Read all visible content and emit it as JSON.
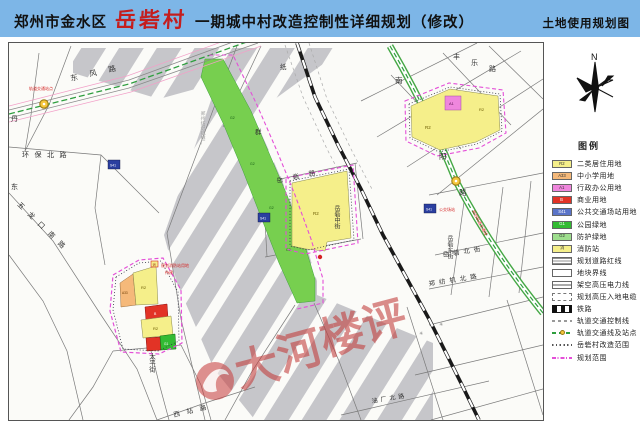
{
  "header": {
    "region": "郑州市金水区",
    "village": "岳砦村",
    "title_rest": "一期城中村改造控制性详细规划（修改）",
    "right_label": "土地使用规划图"
  },
  "side": {
    "compass_label": "N",
    "legend_title": "图例",
    "items": [
      {
        "code": "R2",
        "label": "二类居住用地",
        "type": "fill",
        "color": "#f5ef8a"
      },
      {
        "code": "A33",
        "label": "中小学用地",
        "type": "fill",
        "color": "#f5b97a"
      },
      {
        "code": "A1",
        "label": "行政办公用地",
        "type": "fill",
        "color": "#ef86dd"
      },
      {
        "code": "B",
        "label": "商业用地",
        "type": "fill",
        "color": "#e23326"
      },
      {
        "code": "S41",
        "label": "公共交通场站用地",
        "type": "fill",
        "color": "#5a74c8"
      },
      {
        "code": "G1",
        "label": "公园绿地",
        "type": "fill",
        "color": "#33bb33"
      },
      {
        "code": "G2",
        "label": "防护绿地",
        "type": "fill",
        "color": "#9ede8e"
      },
      {
        "code": "消",
        "label": "消防站",
        "type": "fill",
        "color": "#f5ef8a"
      },
      {
        "label": "规划道路红线",
        "type": "road-redline"
      },
      {
        "label": "地块界线",
        "type": "parcel-line"
      },
      {
        "label": "架空高压电力线",
        "type": "power-line"
      },
      {
        "label": "规划高压入地电缆",
        "type": "cable-line"
      },
      {
        "label": "铁路",
        "type": "railway"
      },
      {
        "label": "轨道交通控制线",
        "type": "metro-control"
      },
      {
        "label": "轨道交通线及站点",
        "type": "metro-line"
      },
      {
        "label": "岳砦村改造范围",
        "type": "village-bound"
      },
      {
        "label": "规划范围",
        "type": "plan-bound"
      }
    ]
  },
  "map": {
    "codes": {
      "r2": "R2",
      "a33": "A33",
      "a1": "A1",
      "b": "B",
      "s41": "S41",
      "g1": "G1",
      "g2": "G2",
      "fire": "消"
    },
    "road_labels": [
      {
        "text": "东风路"
      },
      {
        "text": "环保北路"
      },
      {
        "text": "五龙口南路"
      },
      {
        "text": "丹"
      },
      {
        "text": "东"
      },
      {
        "text": "纸"
      },
      {
        "text": "群"
      },
      {
        "text": "郑州纺织机械厂"
      },
      {
        "text": "岳砦路"
      },
      {
        "text": "岳砦中街"
      },
      {
        "text": "南"
      },
      {
        "text": "阳"
      },
      {
        "text": "路"
      },
      {
        "text": "丰"
      },
      {
        "text": "乐"
      },
      {
        "text": "路"
      },
      {
        "text": "岳砦北街"
      },
      {
        "text": "岳砦东街"
      },
      {
        "text": "郑纺机北路"
      },
      {
        "text": "油厂北路"
      },
      {
        "text": "西站路"
      },
      {
        "text": "太平街"
      }
    ],
    "annotations": [
      {
        "text": "轨道交通站点"
      },
      {
        "text": "规划轨道交通线"
      },
      {
        "text": "公交场站"
      },
      {
        "text": "规划消防站用地"
      },
      {
        "text": "待建"
      }
    ],
    "watermark": {
      "chars": [
        "大",
        "河",
        "楼",
        "评"
      ]
    },
    "colors": {
      "residential": "#f5ef8a",
      "school": "#f5b97a",
      "admin": "#ef86dd",
      "commercial": "#e23326",
      "transit_station": "#2b3fa0",
      "park": "#33bb33",
      "buffer_green": "#77cf4f",
      "plan_boundary": "#e44fd8",
      "metro_line": "#2e9e3e",
      "railway": "#1a1a1a",
      "hatch_gray": "#c6c6ca",
      "header_blue": "#7db6e7",
      "watermark_red": "#c23b3b"
    }
  }
}
